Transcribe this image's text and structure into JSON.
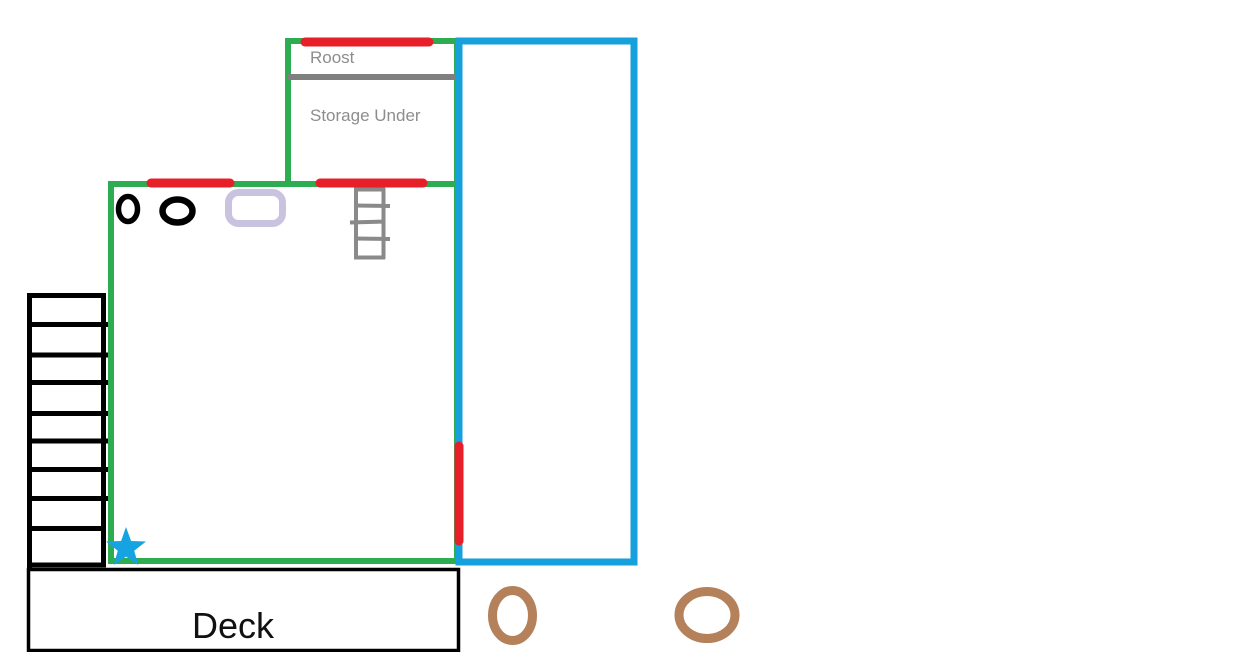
{
  "canvas": {
    "width_px": 1248,
    "height_px": 652,
    "background": "#ffffff",
    "description": "Hand-drawn coop floor plan sketch: Roost with Storage Under, main room, blue run enclosure, exterior stairs, Deck"
  },
  "labels": {
    "roost": "Roost",
    "storage": "Storage Under",
    "deck": "Deck"
  },
  "colors": {
    "wall_green": "#2eac52",
    "run_blue": "#16a0dc",
    "opening_red": "#e61f28",
    "divider_gray": "#7f7f7f",
    "label_gray": "#8d8d8d",
    "ladder_gray": "#8a8a8a",
    "stairs_black": "#000000",
    "egg_black": "#000000",
    "nest_lavender": "#c9c3e0",
    "feeder_brown": "#b5815b",
    "star_blue": "#16a3e2",
    "deck_label_black": "#111111"
  },
  "inventory": {
    "red_wall_openings": 4,
    "black_ovals": 2,
    "brown_ovals": 2,
    "stair_steps": 9,
    "ladder_rungs": 5,
    "star_markers": 1
  }
}
